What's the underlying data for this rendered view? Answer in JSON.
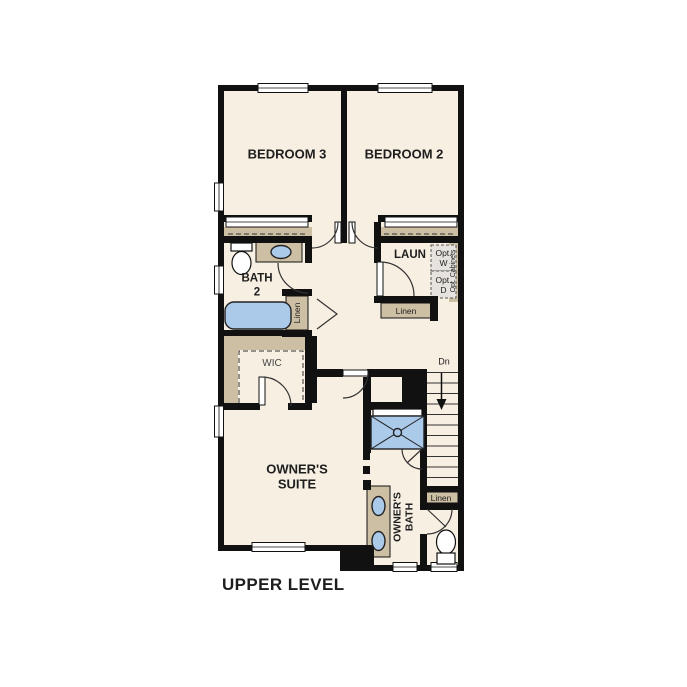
{
  "page_title": "UPPER LEVEL",
  "colors": {
    "wall": "#111111",
    "floor": "#f7efe2",
    "tan": "#cdbfa3",
    "fixture_blue": "#abc9e9",
    "opt_box": "#e6e3de",
    "text": "#1e1e1e",
    "text_muted": "#444444"
  },
  "rooms": {
    "bedroom3": {
      "label": "BEDROOM 3"
    },
    "bedroom2": {
      "label": "BEDROOM 2"
    },
    "bath2": {
      "line1": "BATH",
      "line2": "2"
    },
    "laundry": {
      "label": "LAUN"
    },
    "wic": {
      "label": "WIC"
    },
    "owners_suite": {
      "line1": "OWNER'S",
      "line2": "SUITE"
    },
    "owners_bath": {
      "line1": "OWNER'S",
      "line2": "BATH"
    }
  },
  "options": {
    "washer": {
      "line1": "Opt.",
      "line2": "W"
    },
    "dryer": {
      "line1": "Opt.",
      "line2": "D"
    },
    "cabinets": {
      "label": "Opt. Cabinets"
    }
  },
  "closets": {
    "bath2_linen": "Linen",
    "laundry_linen": "Linen",
    "stairs_linen": "Linen"
  },
  "stairs": {
    "down_label": "Dn"
  }
}
